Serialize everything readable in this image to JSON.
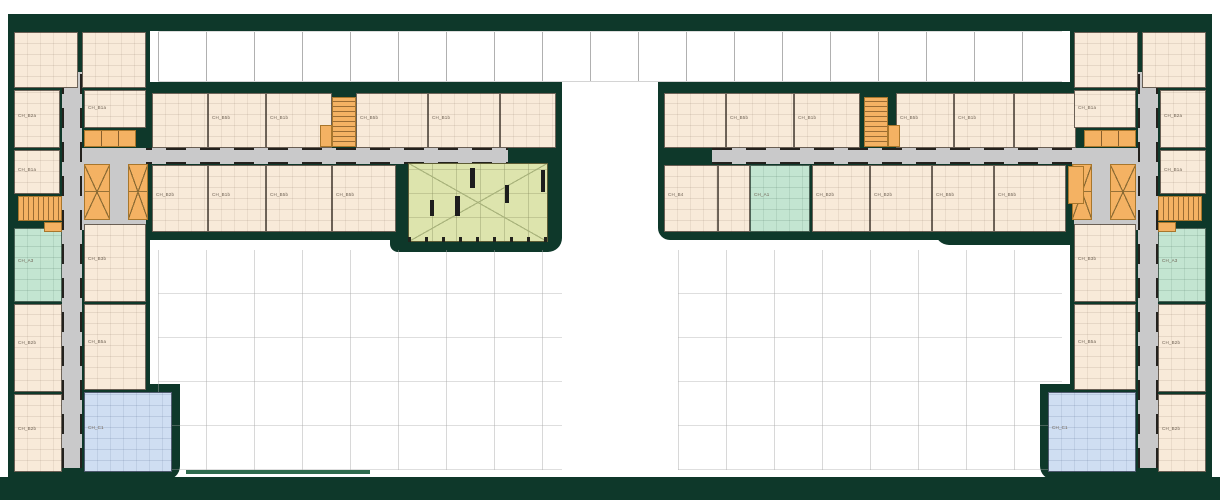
{
  "document": {
    "type": "architectural-floor-plan",
    "description": "Residential building typical floor plan with two mirrored wings around courtyards"
  },
  "colors": {
    "wall_poche": "#0e382a",
    "site_edge": "#2e6b4e",
    "unit_cream": "#f8ead9",
    "unit_mint": "#c3e5d1",
    "unit_blue": "#cfdef2",
    "hall_green": "#dde4ad",
    "core_orange": "#f4b263",
    "corridor_gray": "#c9c9ca",
    "background": "#ffffff"
  },
  "plan": {
    "canvas": {
      "w": 1220,
      "h": 500
    },
    "typeNames": {
      "mass": "building-mass",
      "mass2": "site-edge-line",
      "gridstrip": "canopy-grid-strip",
      "court": "courtyard-grid",
      "corrH": "corridor-horizontal",
      "corrV": "corridor-vertical",
      "pad": "corridor-junction",
      "unit": "apartment-unit",
      "mint": "apartment-unit-mint",
      "blue": "apartment-unit-blue",
      "hall": "community-hall",
      "stairH": "stair-core",
      "stairV": "stair-core",
      "elev": "elevator-core",
      "row3": "service-core-row",
      "blockc": "service-core",
      "col": "structural-column"
    },
    "rects": [
      {
        "t": "mass",
        "n": "top-band",
        "x": 8,
        "y": 14,
        "w": 1204,
        "h": 17
      },
      {
        "t": "mass",
        "n": "left-tower-mass",
        "x": 8,
        "y": 14,
        "w": 142,
        "h": 464
      },
      {
        "t": "mass",
        "n": "right-tower-mass",
        "x": 1070,
        "y": 14,
        "w": 142,
        "h": 464
      },
      {
        "t": "mass",
        "n": "left-wing-mass",
        "x": 150,
        "y": 82,
        "w": 412,
        "h": 158,
        "r": "0 0 12px 0"
      },
      {
        "t": "mass",
        "n": "hall-wing-mass",
        "x": 390,
        "y": 150,
        "w": 172,
        "h": 102,
        "r": "0 0 14px 8px"
      },
      {
        "t": "mass",
        "n": "right-wing-mass",
        "x": 658,
        "y": 82,
        "w": 422,
        "h": 158,
        "r": "0 0 0 12px"
      },
      {
        "t": "mass",
        "n": "right-wing-step-mass",
        "x": 935,
        "y": 165,
        "w": 145,
        "h": 80,
        "r": "0 0 0 14px"
      },
      {
        "t": "mass",
        "n": "left-annex-mass",
        "x": 76,
        "y": 384,
        "w": 104,
        "h": 96,
        "r": "0 0 14px 0"
      },
      {
        "t": "mass",
        "n": "right-annex-mass",
        "x": 1040,
        "y": 384,
        "w": 104,
        "h": 96,
        "r": "0 0 0 14px"
      },
      {
        "t": "mass",
        "n": "bottom-band",
        "x": 0,
        "y": 477,
        "w": 1220,
        "h": 23
      },
      {
        "t": "mass2",
        "n": "site-edge-line",
        "x": 186,
        "y": 470,
        "w": 184,
        "h": 4
      },
      {
        "t": "gridstrip",
        "x": 158,
        "y": 31,
        "w": 904,
        "h": 51
      },
      {
        "t": "court",
        "n": "courtyard-left",
        "x": 158,
        "y": 250,
        "w": 404,
        "h": 220
      },
      {
        "t": "court",
        "n": "courtyard-right",
        "x": 678,
        "y": 250,
        "w": 384,
        "h": 220
      },
      {
        "t": "corrH",
        "x": 64,
        "y": 148,
        "w": 444,
        "h": 16
      },
      {
        "t": "corrH",
        "x": 712,
        "y": 148,
        "w": 446,
        "h": 16
      },
      {
        "t": "corrV",
        "x": 62,
        "y": 72,
        "w": 20,
        "h": 396
      },
      {
        "t": "corrV",
        "x": 1138,
        "y": 72,
        "w": 20,
        "h": 396
      },
      {
        "t": "pad",
        "x": 82,
        "y": 148,
        "w": 64,
        "h": 82
      },
      {
        "t": "pad",
        "x": 1074,
        "y": 148,
        "w": 64,
        "h": 82
      },
      {
        "t": "unit",
        "x": 14,
        "y": 32,
        "w": 64,
        "h": 56
      },
      {
        "t": "unit",
        "x": 82,
        "y": 32,
        "w": 64,
        "h": 56
      },
      {
        "t": "unit",
        "x": 14,
        "y": 90,
        "w": 46,
        "h": 58,
        "l": "CH_B2a"
      },
      {
        "t": "unit",
        "x": 84,
        "y": 90,
        "w": 62,
        "h": 38,
        "l": "CH_B1a"
      },
      {
        "t": "unit",
        "x": 14,
        "y": 150,
        "w": 46,
        "h": 44,
        "l": "CH_B1a"
      },
      {
        "t": "unit",
        "x": 84,
        "y": 224,
        "w": 62,
        "h": 78,
        "l": "CH_B3b"
      },
      {
        "t": "unit",
        "x": 14,
        "y": 304,
        "w": 48,
        "h": 88,
        "l": "CH_B2b"
      },
      {
        "t": "unit",
        "x": 84,
        "y": 304,
        "w": 62,
        "h": 86,
        "l": "CH_B5a"
      },
      {
        "t": "unit",
        "x": 14,
        "y": 394,
        "w": 48,
        "h": 78,
        "l": "CH_B2b"
      },
      {
        "t": "unit",
        "x": 152,
        "y": 93,
        "w": 56,
        "h": 55
      },
      {
        "t": "unit",
        "x": 208,
        "y": 93,
        "w": 58,
        "h": 55,
        "l": "CH_B5b"
      },
      {
        "t": "unit",
        "x": 266,
        "y": 93,
        "w": 66,
        "h": 55,
        "l": "CH_B1b"
      },
      {
        "t": "unit",
        "x": 356,
        "y": 93,
        "w": 72,
        "h": 55,
        "l": "CH_B5b"
      },
      {
        "t": "unit",
        "x": 428,
        "y": 93,
        "w": 72,
        "h": 55,
        "l": "CH_B1b"
      },
      {
        "t": "unit",
        "x": 500,
        "y": 93,
        "w": 56,
        "h": 55
      },
      {
        "t": "unit",
        "x": 152,
        "y": 165,
        "w": 56,
        "h": 67,
        "l": "CH_B2b"
      },
      {
        "t": "unit",
        "x": 208,
        "y": 165,
        "w": 58,
        "h": 67,
        "l": "CH_B1b"
      },
      {
        "t": "unit",
        "x": 266,
        "y": 165,
        "w": 66,
        "h": 67,
        "l": "CH_B5b"
      },
      {
        "t": "unit",
        "x": 332,
        "y": 165,
        "w": 64,
        "h": 67,
        "l": "CH_B5b"
      },
      {
        "t": "unit",
        "x": 664,
        "y": 93,
        "w": 62,
        "h": 55
      },
      {
        "t": "unit",
        "x": 726,
        "y": 93,
        "w": 68,
        "h": 55,
        "l": "CH_B5b"
      },
      {
        "t": "unit",
        "x": 794,
        "y": 93,
        "w": 66,
        "h": 55,
        "l": "CH_B1b"
      },
      {
        "t": "unit",
        "x": 896,
        "y": 93,
        "w": 58,
        "h": 55,
        "l": "CH_B5b"
      },
      {
        "t": "unit",
        "x": 954,
        "y": 93,
        "w": 60,
        "h": 55,
        "l": "CH_B1b"
      },
      {
        "t": "unit",
        "x": 1014,
        "y": 93,
        "w": 62,
        "h": 55
      },
      {
        "t": "unit",
        "x": 664,
        "y": 165,
        "w": 54,
        "h": 67,
        "l": "CH_B4"
      },
      {
        "t": "unit",
        "x": 718,
        "y": 165,
        "w": 32,
        "h": 67
      },
      {
        "t": "unit",
        "x": 812,
        "y": 165,
        "w": 58,
        "h": 67,
        "l": "CH_B2b"
      },
      {
        "t": "unit",
        "x": 870,
        "y": 165,
        "w": 62,
        "h": 67,
        "l": "CH_B2b"
      },
      {
        "t": "unit",
        "x": 932,
        "y": 165,
        "w": 62,
        "h": 67,
        "l": "CH_B5b"
      },
      {
        "t": "unit",
        "x": 994,
        "y": 165,
        "w": 72,
        "h": 67,
        "l": "CH_B5b"
      },
      {
        "t": "unit",
        "x": 1074,
        "y": 32,
        "w": 64,
        "h": 56
      },
      {
        "t": "unit",
        "x": 1142,
        "y": 32,
        "w": 64,
        "h": 56
      },
      {
        "t": "unit",
        "x": 1160,
        "y": 90,
        "w": 46,
        "h": 58,
        "l": "CH_B2a"
      },
      {
        "t": "unit",
        "x": 1074,
        "y": 90,
        "w": 62,
        "h": 38,
        "l": "CH_B1a"
      },
      {
        "t": "unit",
        "x": 1160,
        "y": 150,
        "w": 46,
        "h": 44,
        "l": "CH_B1a"
      },
      {
        "t": "unit",
        "x": 1074,
        "y": 224,
        "w": 62,
        "h": 78,
        "l": "CH_B3b"
      },
      {
        "t": "unit",
        "x": 1158,
        "y": 304,
        "w": 48,
        "h": 88,
        "l": "CH_B2b"
      },
      {
        "t": "unit",
        "x": 1074,
        "y": 304,
        "w": 62,
        "h": 86,
        "l": "CH_B5a"
      },
      {
        "t": "unit",
        "x": 1158,
        "y": 394,
        "w": 48,
        "h": 78,
        "l": "CH_B2b"
      },
      {
        "t": "mint",
        "x": 14,
        "y": 228,
        "w": 48,
        "h": 74,
        "l": "CH_A3"
      },
      {
        "t": "mint",
        "x": 1158,
        "y": 228,
        "w": 48,
        "h": 74,
        "l": "CH_A3"
      },
      {
        "t": "mint",
        "x": 750,
        "y": 165,
        "w": 60,
        "h": 67,
        "l": "CH_A1"
      },
      {
        "t": "blue",
        "x": 84,
        "y": 392,
        "w": 88,
        "h": 80,
        "l": "CH_C1"
      },
      {
        "t": "blue",
        "x": 1048,
        "y": 392,
        "w": 88,
        "h": 80,
        "l": "CH_C1"
      },
      {
        "t": "hall",
        "x": 408,
        "y": 163,
        "w": 140,
        "h": 79
      },
      {
        "t": "col",
        "x": 470,
        "y": 168,
        "w": 5,
        "h": 20
      },
      {
        "t": "col",
        "x": 455,
        "y": 196,
        "w": 5,
        "h": 20
      },
      {
        "t": "col",
        "x": 430,
        "y": 200,
        "w": 4,
        "h": 16
      },
      {
        "t": "col",
        "x": 505,
        "y": 185,
        "w": 4,
        "h": 18
      },
      {
        "t": "col",
        "x": 541,
        "y": 170,
        "w": 4,
        "h": 22
      },
      {
        "t": "stairH",
        "x": 332,
        "y": 97,
        "w": 24,
        "h": 50
      },
      {
        "t": "blockc",
        "x": 320,
        "y": 125,
        "w": 12,
        "h": 22
      },
      {
        "t": "row3",
        "x": 84,
        "y": 130,
        "w": 52,
        "h": 17
      },
      {
        "t": "elev",
        "x": 84,
        "y": 164,
        "w": 26,
        "h": 56
      },
      {
        "t": "elev",
        "x": 128,
        "y": 164,
        "w": 20,
        "h": 56
      },
      {
        "t": "stairV",
        "x": 18,
        "y": 196,
        "w": 44,
        "h": 25
      },
      {
        "t": "blockc",
        "x": 44,
        "y": 222,
        "w": 18,
        "h": 10
      },
      {
        "t": "stairH",
        "x": 864,
        "y": 97,
        "w": 24,
        "h": 50
      },
      {
        "t": "blockc",
        "x": 888,
        "y": 125,
        "w": 12,
        "h": 22
      },
      {
        "t": "row3",
        "x": 1084,
        "y": 130,
        "w": 52,
        "h": 17
      },
      {
        "t": "elev",
        "x": 1110,
        "y": 164,
        "w": 26,
        "h": 56
      },
      {
        "t": "elev",
        "x": 1072,
        "y": 164,
        "w": 20,
        "h": 56
      },
      {
        "t": "stairV",
        "x": 1158,
        "y": 196,
        "w": 44,
        "h": 25
      },
      {
        "t": "blockc",
        "x": 1158,
        "y": 222,
        "w": 18,
        "h": 10
      },
      {
        "t": "blockc",
        "x": 1068,
        "y": 166,
        "w": 16,
        "h": 38
      }
    ]
  }
}
